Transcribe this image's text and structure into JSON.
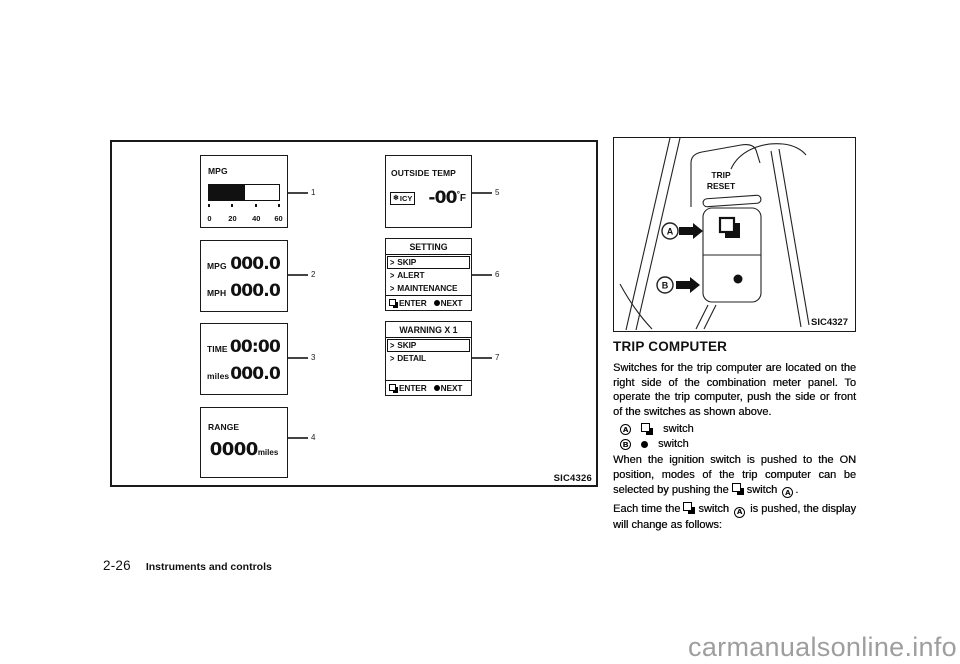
{
  "figure_left": {
    "caption": "SIC4326",
    "mpg_bar": {
      "callout": "1",
      "label": "MPG",
      "fill_width": "51%",
      "ticks": [
        "0",
        "20",
        "40",
        "60"
      ]
    },
    "mpg_mph": {
      "callout": "2",
      "rows": [
        {
          "label": "MPG",
          "value": "000.0"
        },
        {
          "label": "MPH",
          "value": "000.0"
        }
      ]
    },
    "time_miles": {
      "callout": "3",
      "rows": [
        {
          "label": "TIME",
          "value": "00:00"
        },
        {
          "label": "miles",
          "value": "000.0"
        }
      ]
    },
    "range": {
      "callout": "4",
      "label": "RANGE",
      "value": "0000",
      "unit": "miles"
    },
    "outside_temp": {
      "callout": "5",
      "label": "OUTSIDE TEMP",
      "badge_icon": "❄",
      "badge": "ICY",
      "value": "-00",
      "unit_degree": "°",
      "unit_letter": "F"
    },
    "setting": {
      "callout": "6",
      "title": "SETTING",
      "items": [
        {
          "prefix": ">",
          "label": "SKIP"
        },
        {
          "prefix": ">",
          "label": "ALERT"
        },
        {
          "prefix": ">",
          "label": "MAINTENANCE"
        },
        {
          "prefix": ">",
          "label": "OPTIONS"
        }
      ],
      "enter": "ENTER",
      "next": "NEXT"
    },
    "warning": {
      "callout": "7",
      "title": "WARNING X 1",
      "items": [
        {
          "prefix": ">",
          "label": "SKIP"
        },
        {
          "prefix": ">",
          "label": "DETAIL"
        }
      ],
      "enter": "ENTER",
      "next": "NEXT"
    }
  },
  "figure_right": {
    "caption": "SIC4327",
    "trip": "TRIP",
    "reset": "RESET",
    "a": "A",
    "b": "B"
  },
  "content": {
    "heading": "TRIP COMPUTER",
    "para1": "Switches for the trip computer are located on the right side of the combination meter panel. To operate the trip computer, push the side or front of the switches as shown above.",
    "switch_rows": [
      {
        "letter": "A",
        "label": "switch"
      },
      {
        "letter": "B",
        "label": "switch"
      }
    ],
    "para2_pre": "When the ignition switch is pushed to the ON position, modes of the trip computer can be selected by pushing the",
    "para2_switch": "switch",
    "para2_letter": "A",
    "para2_end": ".",
    "para3_pre": "Each time the",
    "para3_switch": "switch",
    "para3_letter": "A",
    "para3_post": "is pushed, the display will change as follows:"
  },
  "footer": {
    "page": "2-26",
    "section": "Instruments and controls"
  },
  "watermark": "carmanualsonline.info"
}
